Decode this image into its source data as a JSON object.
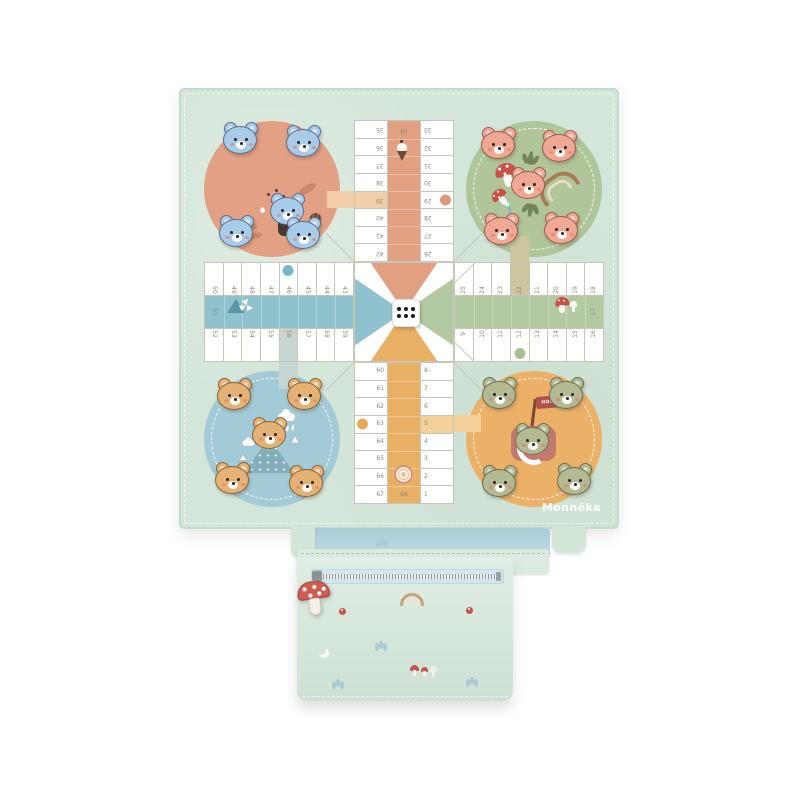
{
  "brand": {
    "label": "Monnëka"
  },
  "board": {
    "game": "parchis-ludo",
    "flag_label": "HOME",
    "die": {
      "pips": 6
    },
    "track": {
      "top": {
        "outer": [
          "35",
          "36",
          "37",
          "38",
          "39",
          "40",
          "41",
          "42"
        ],
        "home": [
          "34",
          "",
          "",
          "",
          "",
          "",
          "",
          ""
        ],
        "inner": [
          "33",
          "32",
          "31",
          "30",
          "29",
          "28",
          "27",
          "26"
        ]
      },
      "right": {
        "top_row": [
          "25",
          "24",
          "23",
          "22",
          "21",
          "20",
          "19",
          "18"
        ],
        "home": [
          "",
          "",
          "",
          "",
          "",
          "",
          "",
          "17"
        ],
        "bottom_row": [
          "9",
          "10",
          "11",
          "12",
          "13",
          "14",
          "15",
          "16"
        ]
      },
      "bottom": {
        "outer": [
          "60",
          "61",
          "62",
          "63",
          "64",
          "65",
          "66",
          "67"
        ],
        "home": [
          "",
          "",
          "",
          "",
          "",
          "",
          "",
          "68"
        ],
        "inner": [
          "8",
          "7",
          "6",
          "5",
          "4",
          "3",
          "2",
          "1"
        ]
      },
      "left": {
        "top_row": [
          "50",
          "49",
          "48",
          "47",
          "46",
          "45",
          "44",
          "43"
        ],
        "home": [
          "51",
          "",
          "",
          "",
          "",
          "",
          "",
          ""
        ],
        "bottom_row": [
          "52",
          "53",
          "54",
          "55",
          "56",
          "57",
          "58",
          "59"
        ]
      },
      "highlight_cells": [
        "39",
        "22",
        "5",
        "56"
      ],
      "dot_cells": [
        "29",
        "12",
        "63",
        "46"
      ]
    },
    "track_icons": [
      "ice-cream-icon",
      "teepee-icon",
      "mushroom-icon",
      "cinnamon-roll-icon"
    ],
    "quadrants": [
      {
        "id": "top-left",
        "circle_color": "#e2a085",
        "pieces": 4,
        "pieces_color": "#a8cbe9",
        "illustration": "blue-bear-with-acorn-leaves-and-dots"
      },
      {
        "id": "top-right",
        "circle_color": "#b1c59a",
        "pieces": 4,
        "pieces_color": "#efa894",
        "illustration": "peach-bear-with-mushrooms-and-rainbow"
      },
      {
        "id": "bottom-left",
        "circle_color": "#a2cbd7",
        "pieces": 4,
        "pieces_color": "#e5b276",
        "illustration": "tan-bear-on-mountain-with-rain-clouds"
      },
      {
        "id": "bottom-right",
        "circle_color": "#ecb168",
        "pieces": 4,
        "pieces_color": "#b3b993",
        "illustration": "green-bear-in-cup-with-home-flag"
      }
    ]
  },
  "pouch": {
    "zipper_charm": "mushroom-charm-icon",
    "prints": [
      "sprig-icon",
      "rainbow-icon",
      "flower-icon",
      "flower-icon",
      "moon-icon",
      "mushrooms-icon",
      "sprig-icon",
      "sprig-icon"
    ]
  },
  "colors": {
    "mat": "#d4e5d9",
    "track_line": "#c6c6b8",
    "home_top": "#e2a083",
    "home_left": "#8fc2cd",
    "home_right": "#b3c9a1",
    "home_bottom": "#e9b166",
    "safe_salmon": "#f2cda9",
    "safe_khaki": "#cdc59c",
    "safe_orange": "#f2cf9b",
    "safe_blue": "#c6d6d2",
    "pouch": "#d9e8dd",
    "lining": "#b7d7e1",
    "zipper_tape": "#d3e6ec",
    "charm_red": "#cd5c51"
  }
}
